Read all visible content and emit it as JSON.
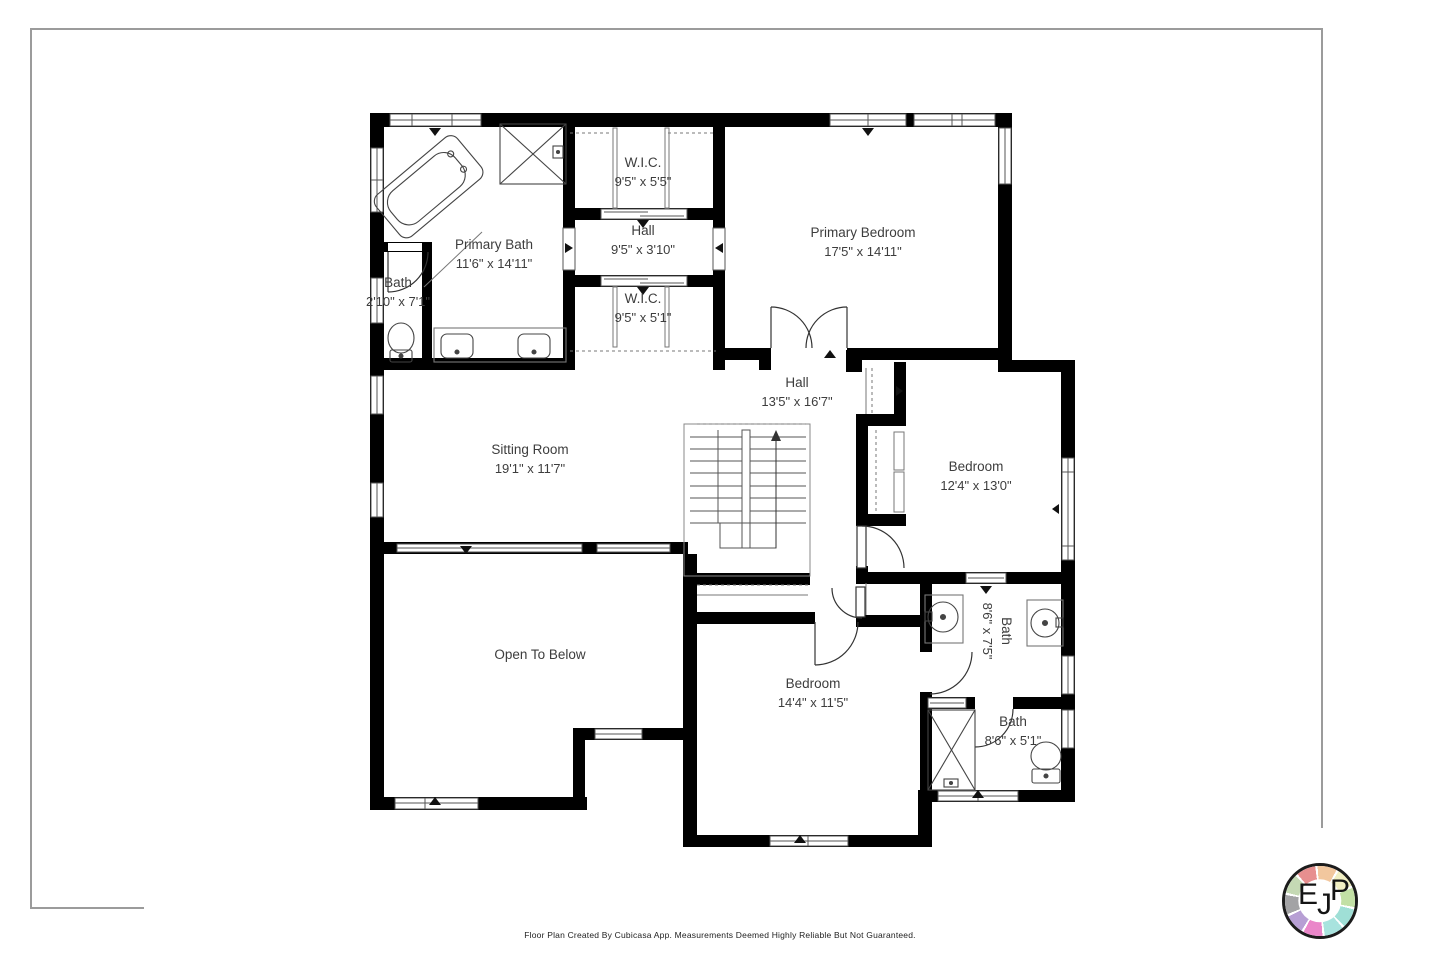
{
  "page": {
    "footer_disclaimer": "Floor Plan Created By Cubicasa App. Measurements Deemed Highly Reliable But Not Guaranteed."
  },
  "rooms": [
    {
      "name": "W.I.C.",
      "dims": "9'5\" x 5'5\""
    },
    {
      "name": "Hall",
      "dims": "9'5\" x 3'10\""
    },
    {
      "name": "W.I.C.",
      "dims": "9'5\" x 5'1\""
    },
    {
      "name": "Primary Bath",
      "dims": "11'6\" x 14'11\""
    },
    {
      "name": "Bath",
      "dims": "2'10\" x 7'1\""
    },
    {
      "name": "Primary Bedroom",
      "dims": "17'5\" x 14'11\""
    },
    {
      "name": "Hall",
      "dims": "13'5\" x 16'7\""
    },
    {
      "name": "Sitting Room",
      "dims": "19'1\" x 11'7\""
    },
    {
      "name": "Bedroom",
      "dims": "12'4\" x 13'0\""
    },
    {
      "name": "Open To Below",
      "dims": ""
    },
    {
      "name": "Bedroom",
      "dims": "14'4\" x 11'5\""
    },
    {
      "name": "Bath",
      "dims": "8'6\" x 7'5\""
    },
    {
      "name": "Bath",
      "dims": "8'6\" x 5'1\""
    }
  ],
  "logo": {
    "letters": {
      "e": "E",
      "j": "J",
      "p": "P"
    },
    "ring_colors": [
      "#e78f8f",
      "#f2c79e",
      "#f0eec2",
      "#c2e0a5",
      "#9fdfd6",
      "#a8e3de",
      "#ea86c9",
      "#b79fd4",
      "#a3a3a5",
      "#c5d9b4"
    ]
  },
  "colors": {
    "wall": "#000000",
    "line": "#4a4a4a",
    "thin": "#8a8a8a",
    "text": "#3d3d3d",
    "frame": "#9b9b9b",
    "footer": "#222222"
  }
}
